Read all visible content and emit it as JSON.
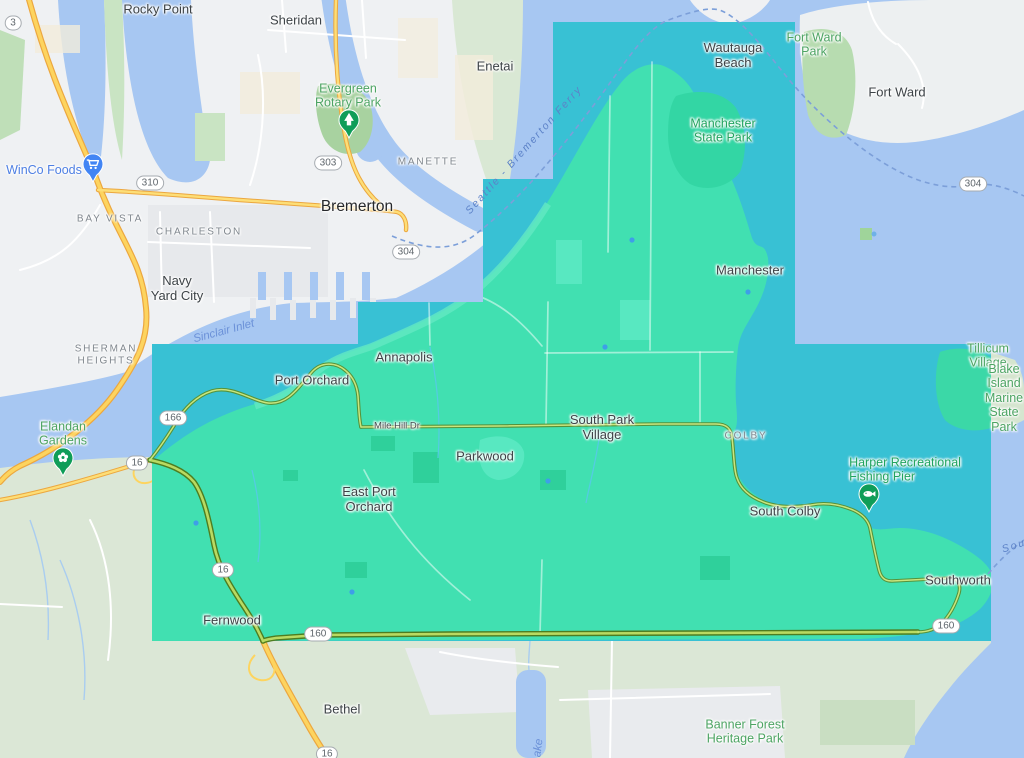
{
  "map": {
    "colors": {
      "water": "#a7c7f2",
      "land_gray": "#eff1f3",
      "land_sage": "#dbe7d6",
      "overlay_water": "#38c1d4",
      "overlay_land": "#41e0b1",
      "highway_yellow": "#fdd45f",
      "highway_green": "#b9da62",
      "pin_green": "#0f9d58",
      "pin_blue": "#4285f4"
    },
    "labels": [
      {
        "name": "rocky-point",
        "type": "town",
        "text": "Rocky Point",
        "x": 158,
        "y": 10
      },
      {
        "name": "sheridan",
        "type": "town",
        "text": "Sheridan",
        "x": 296,
        "y": 21
      },
      {
        "name": "enetai",
        "type": "town",
        "text": "Enetai",
        "x": 495,
        "y": 67
      },
      {
        "name": "fort-ward",
        "type": "town",
        "text": "Fort Ward",
        "x": 897,
        "y": 93
      },
      {
        "name": "wautauga-beach",
        "type": "town",
        "text": "Wautauga\nBeach",
        "x": 733,
        "y": 56
      },
      {
        "name": "manchester",
        "type": "town",
        "text": "Manchester",
        "x": 750,
        "y": 271
      },
      {
        "name": "bremerton",
        "type": "city",
        "text": "Bremerton",
        "x": 357,
        "y": 207
      },
      {
        "name": "navy-yard-city",
        "type": "town",
        "text": "Navy\nYard City",
        "x": 177,
        "y": 289
      },
      {
        "name": "annapolis",
        "type": "town",
        "text": "Annapolis",
        "x": 404,
        "y": 358
      },
      {
        "name": "port-orchard",
        "type": "town",
        "text": "Port Orchard",
        "x": 312,
        "y": 381
      },
      {
        "name": "parkwood",
        "type": "town",
        "text": "Parkwood",
        "x": 485,
        "y": 457
      },
      {
        "name": "east-port-orchard",
        "type": "town",
        "text": "East Port\nOrchard",
        "x": 369,
        "y": 500
      },
      {
        "name": "south-park-village",
        "type": "town",
        "text": "South Park\nVillage",
        "x": 602,
        "y": 428
      },
      {
        "name": "south-colby",
        "type": "town",
        "text": "South Colby",
        "x": 785,
        "y": 512
      },
      {
        "name": "southworth",
        "type": "town",
        "text": "Southworth",
        "x": 958,
        "y": 581
      },
      {
        "name": "fernwood",
        "type": "town",
        "text": "Fernwood",
        "x": 232,
        "y": 621
      },
      {
        "name": "bethel",
        "type": "town",
        "text": "Bethel",
        "x": 342,
        "y": 710
      },
      {
        "name": "manette",
        "type": "hood",
        "text": "MANETTE",
        "x": 428,
        "y": 162
      },
      {
        "name": "bay-vista",
        "type": "hood",
        "text": "BAY VISTA",
        "x": 110,
        "y": 219
      },
      {
        "name": "charleston",
        "type": "hood",
        "text": "CHARLESTON",
        "x": 199,
        "y": 232
      },
      {
        "name": "sherman-heights",
        "type": "hood",
        "text": "SHERMAN\nHEIGHTS",
        "x": 106,
        "y": 355
      },
      {
        "name": "colby",
        "type": "hood",
        "text": "COLBY",
        "x": 746,
        "y": 436
      },
      {
        "name": "evergreen-rotary-park",
        "type": "park",
        "text": "Evergreen\nRotary Park",
        "x": 348,
        "y": 96
      },
      {
        "name": "fort-ward-park",
        "type": "park",
        "text": "Fort Ward\nPark",
        "x": 814,
        "y": 45
      },
      {
        "name": "manchester-state-park",
        "type": "parkb",
        "text": "Manchester\nState Park",
        "x": 723,
        "y": 131
      },
      {
        "name": "elandan-gardens",
        "type": "park",
        "text": "Elandan\nGardens",
        "x": 63,
        "y": 434
      },
      {
        "name": "harper-recreational-fishing-pier",
        "type": "parkb",
        "text": "Harper Recreational\nFishing Pier",
        "x": 905,
        "y": 470,
        "align": "left"
      },
      {
        "name": "tillicum-village",
        "type": "park",
        "text": "Tillicum Village",
        "x": 988,
        "y": 356
      },
      {
        "name": "blake-island-marine-state-park",
        "type": "park",
        "text": "Blake Island\nMarine\nState Park",
        "x": 1004,
        "y": 398
      },
      {
        "name": "banner-forest-heritage-park",
        "type": "park",
        "text": "Banner Forest\nHeritage Park",
        "x": 745,
        "y": 732
      },
      {
        "name": "winco-foods",
        "type": "store",
        "text": "WinCo Foods",
        "x": 44,
        "y": 170
      },
      {
        "name": "sinclair-inlet",
        "type": "water",
        "text": "Sinclair Inlet",
        "x": 224,
        "y": 332,
        "rot": -15
      },
      {
        "name": "seattle-bremerton-ferry",
        "type": "ferry",
        "text": "Seattle - Bremerton Ferry",
        "x": 524,
        "y": 150,
        "rot": -48
      },
      {
        "name": "southworth-ferry",
        "type": "ferry",
        "text": "Sou",
        "x": 1014,
        "y": 546,
        "rot": -18
      },
      {
        "name": "lake-label",
        "type": "water",
        "text": "ake",
        "x": 539,
        "y": 748,
        "rot": -83
      },
      {
        "name": "mile-hill-dr",
        "type": "street",
        "text": "Mile Hill Dr",
        "x": 397,
        "y": 427
      }
    ],
    "shields": [
      {
        "text": "3",
        "x": 13,
        "y": 23
      },
      {
        "text": "310",
        "x": 150,
        "y": 183
      },
      {
        "text": "303",
        "x": 328,
        "y": 163
      },
      {
        "text": "304",
        "x": 406,
        "y": 252
      },
      {
        "text": "304",
        "x": 973,
        "y": 184
      },
      {
        "text": "166",
        "x": 173,
        "y": 418
      },
      {
        "text": "16",
        "x": 137,
        "y": 463
      },
      {
        "text": "16",
        "x": 223,
        "y": 570
      },
      {
        "text": "16",
        "x": 327,
        "y": 754
      },
      {
        "text": "160",
        "x": 318,
        "y": 634
      },
      {
        "text": "160",
        "x": 946,
        "y": 626
      }
    ],
    "pins": [
      {
        "name": "evergreen-rotary-park-pin",
        "kind": "tree",
        "x": 349,
        "y": 120,
        "color": "#0f9d58"
      },
      {
        "name": "elandan-gardens-pin",
        "kind": "flower",
        "x": 63,
        "y": 458,
        "color": "#0f9d58"
      },
      {
        "name": "harper-pier-pin",
        "kind": "fish",
        "x": 869,
        "y": 494,
        "color": "#0f9d58"
      },
      {
        "name": "winco-foods-pin",
        "kind": "cart",
        "x": 93,
        "y": 164,
        "color": "#4285f4"
      }
    ]
  }
}
